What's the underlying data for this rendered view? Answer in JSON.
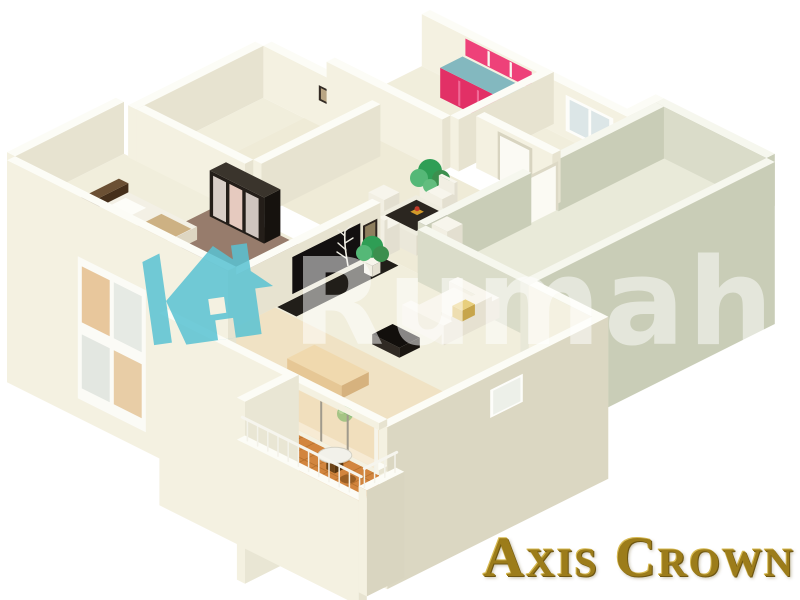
{
  "watermark": {
    "text": "Rumah",
    "icon": "house-icon",
    "icon_color": "#58c2d2",
    "text_color": "#ffffff",
    "text_opacity": 0.5
  },
  "brand": {
    "text": "Axis Crown",
    "color": "#9c7c1a"
  },
  "scene": {
    "type": "3d-floor-plan-render",
    "background": "#ffffff",
    "visible_features": [
      "kitchen-with-red-cabinets-and-teal-counter",
      "dining-table-with-four-white-chairs",
      "living-room-white-sofa-and-black-tv-panel",
      "bedroom-with-mirrored-wardrobe",
      "bedroom-with-bed-and-cross-frame-window",
      "large-empty-sage-room",
      "warm-lit-bedroom-with-glass-wall",
      "balcony-with-terracotta-tiles-round-table-and-railing",
      "potted-plants",
      "white-doors"
    ]
  },
  "palette": {
    "background": "#ffffff",
    "wall_face": "#f4f1e1",
    "wall_shade": "#e7e3d0",
    "wall_top": "#fcfcf6",
    "sage_face": "#dadcc9",
    "sage_shade": "#c9cdb7",
    "floor": "#f1eedc",
    "floor_open": "#efebd7",
    "floor_sage": "#e9ead9",
    "floor_warm": "#f0e2c4",
    "floor_brown": "#977c6c",
    "floor_terracotta": "#d2853e",
    "tile_line": "#b5702c",
    "cabinet_red": "#e23066",
    "counter_teal": "#83b8bf",
    "sofa": "#f4f1e6",
    "dark_furniture": "#2b2620",
    "plant": "#2f9e55",
    "watermark_teal": "#58c2d2",
    "gold": "#9c7c1a"
  }
}
